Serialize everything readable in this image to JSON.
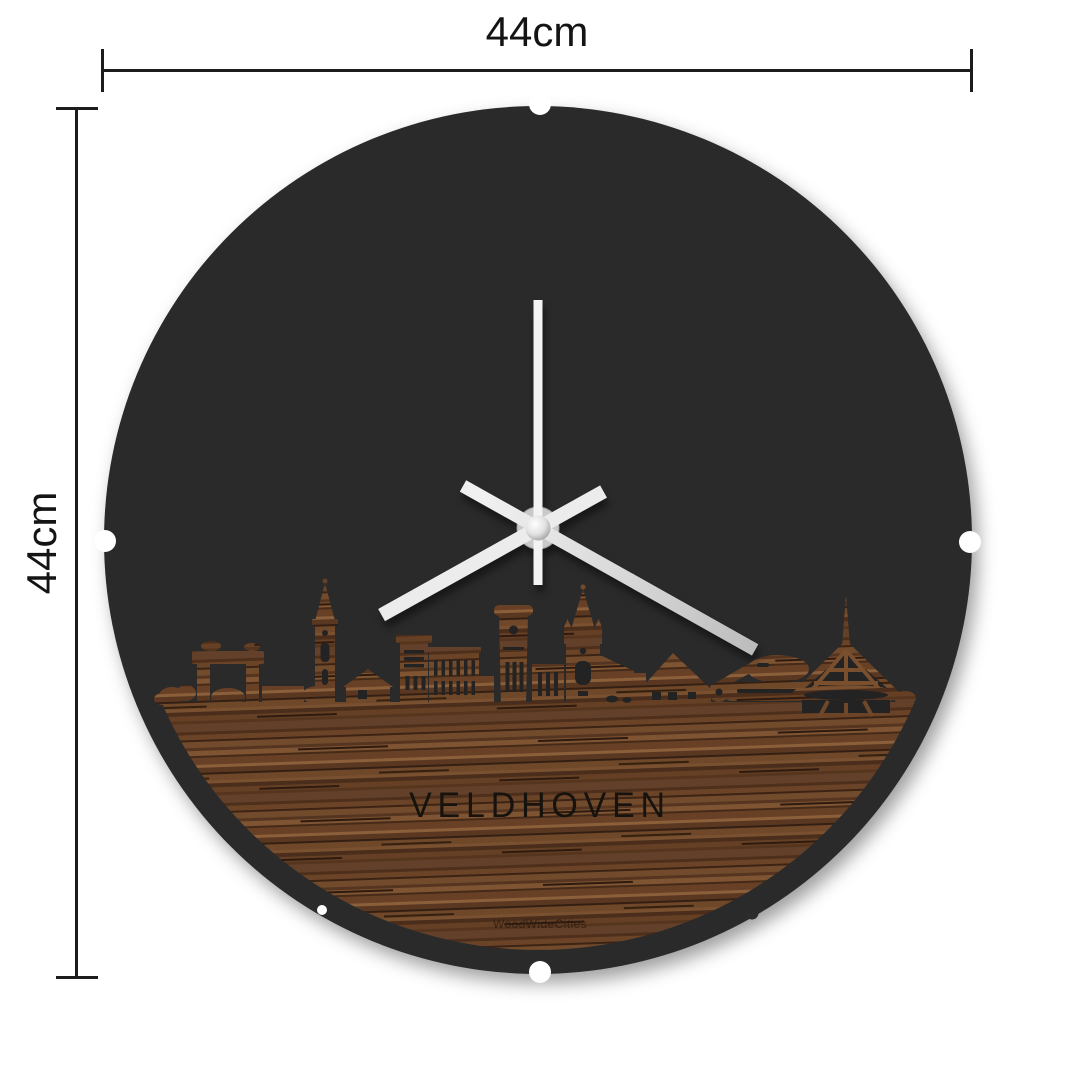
{
  "diagram": {
    "width_label": "44cm",
    "height_label": "44cm"
  },
  "clock": {
    "city_label": "VELDHOVEN",
    "brand_label": "WoodWideCities",
    "face_color": "#2b2b2b",
    "cutout_color": "#232323",
    "hand_color": "#ececec",
    "second_hand_color": "#f3f3f3",
    "wood_tones": [
      "#5d3a23",
      "#724b2c",
      "#7e5433",
      "#4a2c18",
      "#342013"
    ],
    "hands": {
      "hour_angle_deg": 240.9,
      "minute_angle_deg": 119.3,
      "second_angle_deg": 0
    }
  }
}
